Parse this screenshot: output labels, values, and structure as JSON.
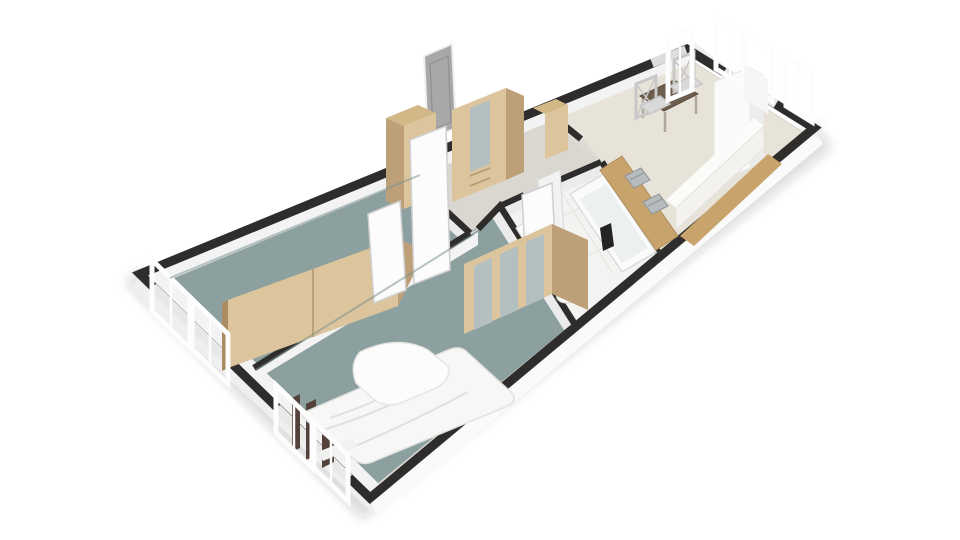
{
  "scene": {
    "type": "3d-floor-plan",
    "view": "isometric top-down render of a two-bedroom apartment, no text labels",
    "rooms": [
      {
        "id": "bedroom-1",
        "floor": "teal carpet",
        "contents": [
          "two-door wood wardrobe",
          "west windows"
        ]
      },
      {
        "id": "bedroom-2",
        "floor": "teal carpet",
        "contents": [
          "double bed with white duvet",
          "three-door mirrored wardrobe",
          "west windows"
        ]
      },
      {
        "id": "hallway",
        "floor": "light grey",
        "contents": [
          "entry door",
          "two tall wood cabinets",
          "open white doors"
        ]
      },
      {
        "id": "bathroom",
        "floor": "white tile",
        "contents": [
          "bathtub",
          "vanity with sink and mirror",
          "toilet"
        ]
      },
      {
        "id": "kitchen-living",
        "floor": "beige",
        "contents": [
          "counter with twin sinks",
          "tall white column",
          "long white island",
          "dining table",
          "two chairs",
          "windows"
        ]
      }
    ]
  },
  "palette": {
    "bg": "#ffffff",
    "shadow": "rgba(40,40,40,0.16)",
    "cap": "#2e2d2c",
    "wall_outer_sw": "#efefef",
    "wall_outer_se": "#fafafa",
    "wall_inner": "#ebebeb",
    "wall_face": "#f3f3f3",
    "base_floor": "#dedbd4",
    "teal": "#8ba09f",
    "teal_edge": "#7c918f",
    "hall_floor": "#dad7d1",
    "bath_floor": "#f3f3f1",
    "bath_tile_line": "#e2e2df",
    "kitchen_floor": "#e7e3d9",
    "wood_front": "#dcc49c",
    "wood_top": "#d2b787",
    "wood_side": "#bda077",
    "wood_dark": "#a98c60",
    "counter_wood": "#c9a36c",
    "door_gray": "#a8a8a8",
    "door_gray_dark": "#8f8f8f",
    "door_white": "#fcfcfc",
    "door_edge": "#cfcfcf",
    "mirror": "#b4bfc1",
    "steel": "#b6bbbd",
    "steel_dark": "#989ea1",
    "table_top": "#6d5d4c",
    "table_edge": "#5d4e3f",
    "chair": "#c7c7c7",
    "chair_seat": "#d9d9d9",
    "bed_white": "#f7f7f6",
    "bed_fold": "#e0e0de",
    "bed_base": "#53413a",
    "fixture_white": "#fbfbfb",
    "fixture_edge": "#dcdcdc",
    "tub_inner": "#edf0f0",
    "window_white": "#fdfdfd",
    "window_edge": "#d8d8d8",
    "black_item": "#242424",
    "island_front": "#f3f2ee",
    "island_top": "#fbfbf9"
  }
}
